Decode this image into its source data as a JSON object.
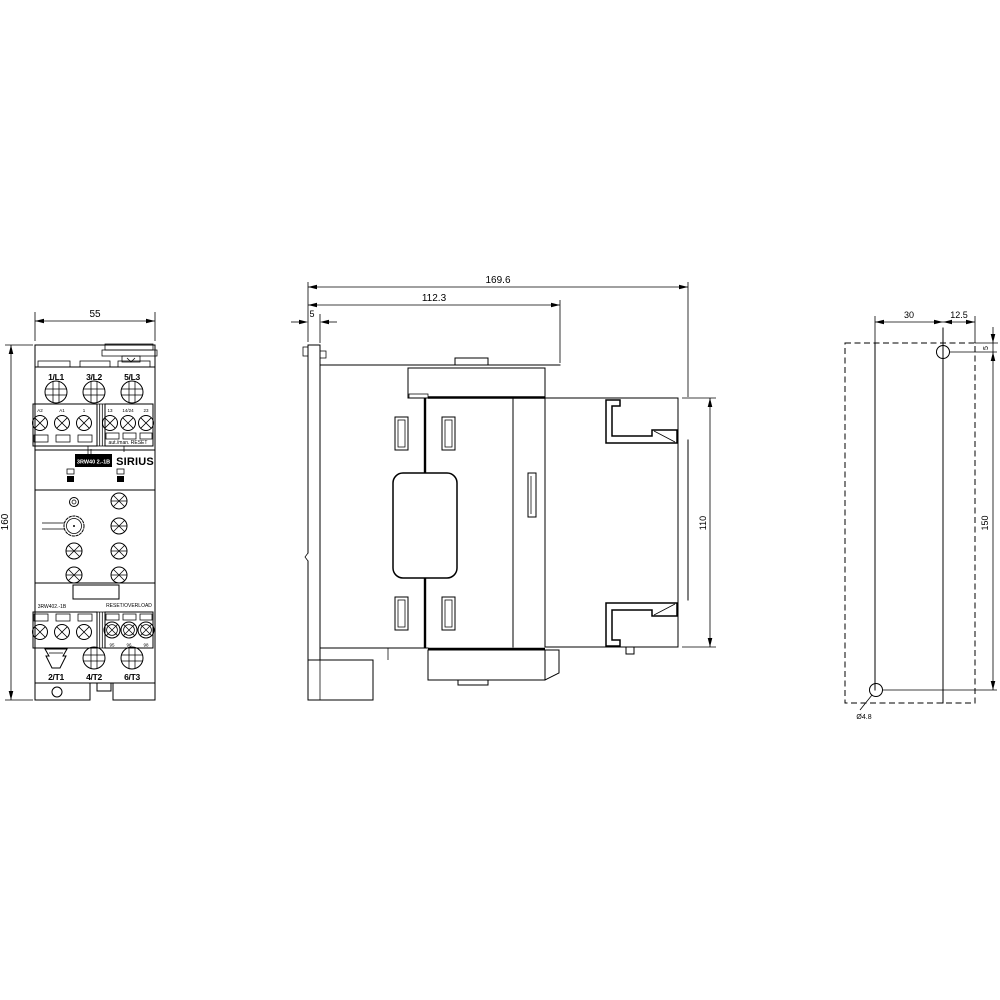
{
  "drawing": {
    "front": {
      "dim_width": "55",
      "dim_height": "160",
      "power_in": [
        "1/L1",
        "3/L2",
        "5/L3"
      ],
      "power_out": [
        "2/T1",
        "4/T2",
        "6/T3"
      ],
      "ctrl_left": [
        "A2",
        "A1",
        "1"
      ],
      "ctrl_right": [
        "13",
        "14/24",
        "23"
      ],
      "relay": [
        "95",
        "96",
        "98"
      ],
      "brand": "SIRIUS",
      "type_plate": "3RW40 2.-1B",
      "type_note": "3RW402.-1B",
      "reset_note": "RESET/OVERLOAD",
      "aux_note": "aut./man. RESET"
    },
    "side": {
      "dim_depth_total": "169.6",
      "dim_depth_front": "112.3",
      "dim_front_plate": "5",
      "dim_mount_height": "110"
    },
    "rear": {
      "dim_hole_offset": "30",
      "dim_hole_to_edge": "12.5",
      "dim_top_offset": "5",
      "dim_hole_spacing": "150",
      "hole_diameter": "Ø4.8"
    }
  }
}
